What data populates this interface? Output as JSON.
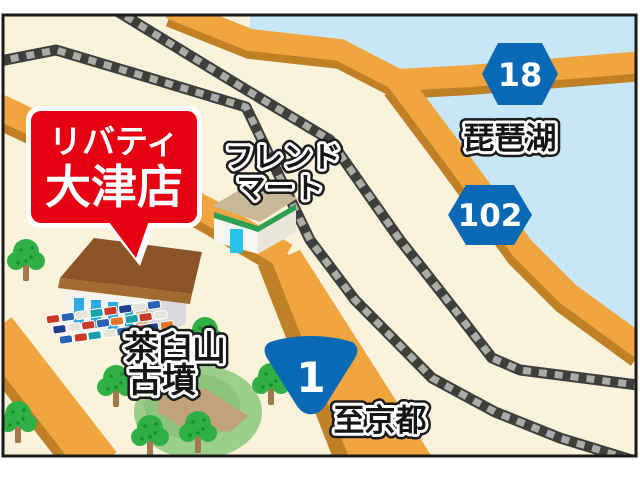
{
  "map": {
    "store_bubble": {
      "line1": "リバティ",
      "line2": "大津店"
    },
    "landmarks": {
      "friend_mart": {
        "line1": "フレンド",
        "line2": "マート"
      },
      "lake_name": "琵琶湖",
      "kofun": {
        "line1": "茶臼山",
        "line2": "古墳"
      },
      "direction_south": "至京都"
    },
    "route_shields": {
      "r18": "18",
      "r102": "102",
      "r1": "1"
    },
    "colors": {
      "brand_red": "#E50012",
      "road_orange": "#F0A53F",
      "road_shadow": "#BF8026",
      "lake_blue": "#C7E7F8",
      "land_cream": "#FAF2DB",
      "railway_dark": "#3E3E3C",
      "railway_tie": "#ABABA8",
      "shield_blue": "#0A69B5",
      "park_green": "#9CCF8C",
      "tree_green": "#2FAF44"
    }
  }
}
